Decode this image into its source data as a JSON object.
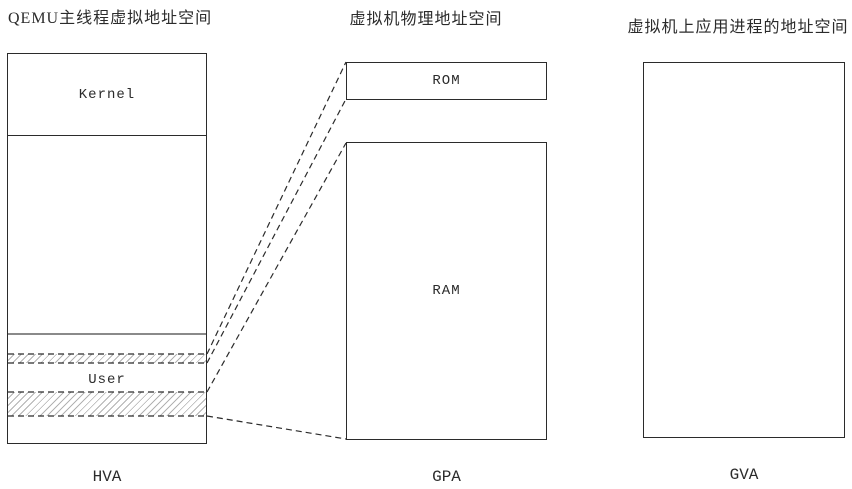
{
  "diagram": {
    "left": {
      "title": "QEMU主线程虚拟地址空间",
      "kernel_label": "Kernel",
      "user_label": "User",
      "axis": "HVA"
    },
    "middle": {
      "title": "虚拟机物理地址空间",
      "rom_label": "ROM",
      "ram_label": "RAM",
      "axis": "GPA"
    },
    "right": {
      "title": "虚拟机上应用进程的地址空间",
      "axis": "GVA"
    },
    "colors": {
      "line": "#2b2b2b",
      "divider_gray": "#8a8a8a",
      "background": "#ffffff"
    }
  }
}
